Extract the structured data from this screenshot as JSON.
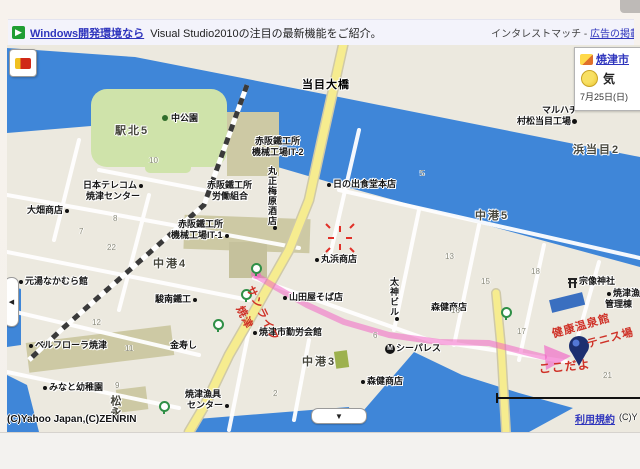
{
  "banner": {
    "play_icon": "▶",
    "link": "Windows開発環境なら",
    "text": "Visual Studio2010の注目の最新機能をご紹介。",
    "right_plain": "インタレストマッチ -",
    "right_link": "広告の掲載"
  },
  "weather": {
    "city": "焼津市",
    "temp": "気",
    "date": "7月25日(日)"
  },
  "controls": {
    "pan_left": "◀",
    "pan_down": "▼"
  },
  "footer": {
    "copyright": "(C)Yahoo Japan,(C)ZENRIN",
    "terms": "利用規約",
    "copyright2": "(C)Y"
  },
  "colors": {
    "water": "#3f86d8",
    "road_yellow": "#f6ec8f",
    "park_green": "#cfe3aa",
    "route_pink": "#f25ac4",
    "pen_red": "#cf3127",
    "marker_navy": "#1c2f70"
  },
  "map": {
    "labels": [
      {
        "t": "当目大橋",
        "x": 295,
        "y": 35,
        "cls": "bridge",
        "n": "label-toume-ohashi"
      },
      {
        "t": "駅北5",
        "x": 108,
        "y": 81,
        "cls": "district",
        "n": "label-ekikita5"
      },
      {
        "t": "中公園",
        "x": 164,
        "y": 69,
        "cls": "",
        "n": "label-naka-park"
      },
      {
        "x": 155,
        "y": 70,
        "cls": "tree",
        "n": "tree-icon"
      },
      {
        "t": "日本テレコム",
        "x": 76,
        "y": 136,
        "cls": "dr",
        "n": "label-japan-telecom"
      },
      {
        "t": "焼津センター",
        "x": 79,
        "y": 147,
        "cls": "",
        "n": "label-yaizu-center"
      },
      {
        "t": "大畑商店",
        "x": 20,
        "y": 161,
        "cls": "dr",
        "n": "label-ohata-shoten"
      },
      {
        "t": "赤阪鐵工所",
        "x": 248,
        "y": 92,
        "cls": "",
        "n": "label-akasaka-ironworks"
      },
      {
        "t": "機械工場IT-2",
        "x": 245,
        "y": 103,
        "cls": "",
        "n": "label-machine-plant-it2"
      },
      {
        "t": "赤阪鐵工所",
        "x": 200,
        "y": 136,
        "cls": "",
        "n": "label-akasaka-ironworks2"
      },
      {
        "t": "労働組合",
        "x": 205,
        "y": 147,
        "cls": "",
        "n": "label-labor-union"
      },
      {
        "t": "赤阪鐵工所",
        "x": 171,
        "y": 175,
        "cls": "",
        "n": "label-akasaka-ironworks3"
      },
      {
        "t": "機械工場IT-1",
        "x": 164,
        "y": 186,
        "cls": "dr",
        "n": "label-machine-plant-it1"
      },
      {
        "t": "丸正梅原酒店",
        "x": 260,
        "y": 121,
        "cls": "vert dr",
        "n": "label-marusho-umehara-sake"
      },
      {
        "t": "日の出食堂本店",
        "x": 320,
        "y": 135,
        "cls": "dl",
        "n": "label-hinode-shokudo"
      },
      {
        "t": "マルハチ",
        "x": 535,
        "y": 61,
        "cls": "",
        "n": "label-maruhachi"
      },
      {
        "t": "村松当目工場",
        "x": 510,
        "y": 72,
        "cls": "",
        "n": "label-muramatsu-toume-plant"
      },
      {
        "x": 565,
        "y": 74,
        "cls": "gear",
        "n": "factory-icon"
      },
      {
        "t": "浜当目2",
        "x": 566,
        "y": 100,
        "cls": "district",
        "n": "label-hamatoume2"
      },
      {
        "t": "中港5",
        "x": 468,
        "y": 166,
        "cls": "district",
        "n": "label-nakaminato5"
      },
      {
        "t": "中港4",
        "x": 146,
        "y": 214,
        "cls": "district",
        "n": "label-nakaminato4"
      },
      {
        "t": "元湯なかむら館",
        "x": 12,
        "y": 232,
        "cls": "dl",
        "n": "label-motoyu-nakamura"
      },
      {
        "t": "駿南鐵工",
        "x": 148,
        "y": 250,
        "cls": "dr",
        "n": "label-sunnan-tekko"
      },
      {
        "t": "丸浜商店",
        "x": 308,
        "y": 210,
        "cls": "dl",
        "n": "label-maruhama-shoten"
      },
      {
        "t": "山田屋そば店",
        "x": 276,
        "y": 248,
        "cls": "dl",
        "n": "label-yamadaya-soba"
      },
      {
        "t": "太神ビル",
        "x": 382,
        "y": 232,
        "cls": "vert dr",
        "n": "label-taijin-building"
      },
      {
        "t": "森健商店",
        "x": 424,
        "y": 258,
        "cls": "",
        "n": "label-moriken-shoten-upper"
      },
      {
        "t": "宗像神社",
        "x": 572,
        "y": 232,
        "cls": "",
        "n": "label-munakata-shrine"
      },
      {
        "x": 561,
        "y": 233,
        "cls": "torii",
        "n": "torii-icon"
      },
      {
        "t": "ベルフローラ焼津",
        "x": 22,
        "y": 296,
        "cls": "dl",
        "n": "label-belleflora-yaizu"
      },
      {
        "t": "金寿し",
        "x": 163,
        "y": 296,
        "cls": "",
        "n": "label-kinzushi"
      },
      {
        "t": "焼津市勤労会館",
        "x": 246,
        "y": 283,
        "cls": "dl",
        "n": "label-yaizu-kinro-kaikan"
      },
      {
        "t": "シーパレス",
        "x": 389,
        "y": 299,
        "cls": "",
        "n": "label-sea-palace"
      },
      {
        "t": "M",
        "x": 378,
        "y": 299,
        "cls": "micon",
        "n": "hotel-m-icon"
      },
      {
        "t": "中港3",
        "x": 295,
        "y": 312,
        "cls": "district",
        "n": "label-nakaminato3"
      },
      {
        "t": "森健商店",
        "x": 354,
        "y": 332,
        "cls": "dl",
        "n": "label-moriken-shoten-lower"
      },
      {
        "t": "みなと幼稚園",
        "x": 36,
        "y": 338,
        "cls": "dl",
        "n": "label-minato-kindergarten"
      },
      {
        "t": "焼津漁具",
        "x": 178,
        "y": 345,
        "cls": "",
        "n": "label-yaizu-gyogu"
      },
      {
        "t": "センター",
        "x": 180,
        "y": 356,
        "cls": "dr",
        "n": "label-yaizu-gyogu-center"
      },
      {
        "t": "松永",
        "x": 102,
        "y": 350,
        "cls": "district vert",
        "n": "label-matsunaga"
      },
      {
        "t": "焼津漁港",
        "x": 600,
        "y": 244,
        "cls": "dl",
        "n": "label-yaizu-fishing-port"
      },
      {
        "t": "管理棟",
        "x": 598,
        "y": 255,
        "cls": "",
        "n": "label-kanri-building"
      }
    ],
    "numbers": [
      {
        "t": "10",
        "x": 142,
        "y": 111
      },
      {
        "t": "8",
        "x": 106,
        "y": 169
      },
      {
        "t": "7",
        "x": 72,
        "y": 182
      },
      {
        "t": "22",
        "x": 100,
        "y": 198
      },
      {
        "t": "5",
        "x": 413,
        "y": 124
      },
      {
        "t": "12",
        "x": 85,
        "y": 273
      },
      {
        "t": "11",
        "x": 118,
        "y": 299
      },
      {
        "t": "9",
        "x": 108,
        "y": 336
      },
      {
        "t": "2",
        "x": 266,
        "y": 344
      },
      {
        "t": "6",
        "x": 366,
        "y": 286
      },
      {
        "t": "13",
        "x": 438,
        "y": 207
      },
      {
        "t": "15",
        "x": 474,
        "y": 232
      },
      {
        "t": "16",
        "x": 444,
        "y": 261
      },
      {
        "t": "18",
        "x": 524,
        "y": 222
      },
      {
        "t": "17",
        "x": 510,
        "y": 282
      },
      {
        "t": "21",
        "x": 596,
        "y": 326
      }
    ],
    "bus_stops": [
      {
        "x": 244,
        "y": 218,
        "n": "bus-stop-icon"
      },
      {
        "x": 234,
        "y": 244,
        "n": "bus-stop-icon"
      },
      {
        "x": 206,
        "y": 274,
        "n": "bus-stop-icon"
      },
      {
        "x": 494,
        "y": 262,
        "n": "bus-stop-icon"
      },
      {
        "x": 152,
        "y": 356,
        "n": "bus-stop-icon"
      }
    ],
    "pen": [
      {
        "t": "サンライフ",
        "x": 250,
        "y": 238,
        "r": 64,
        "n": "handwriting-sunlife"
      },
      {
        "t": "焼津",
        "x": 240,
        "y": 258,
        "r": 64,
        "n": "handwriting-yaizu"
      },
      {
        "t": "健康温泉館",
        "x": 543,
        "y": 281,
        "r": -16,
        "n": "handwriting-kenko-onsenkan"
      },
      {
        "t": "テニス場",
        "x": 578,
        "y": 291,
        "r": -15,
        "n": "handwriting-tennis-court"
      },
      {
        "t": "ここだよ",
        "x": 531,
        "y": 315,
        "r": -5,
        "fs": 12,
        "n": "handwriting-kokodayo"
      }
    ]
  }
}
